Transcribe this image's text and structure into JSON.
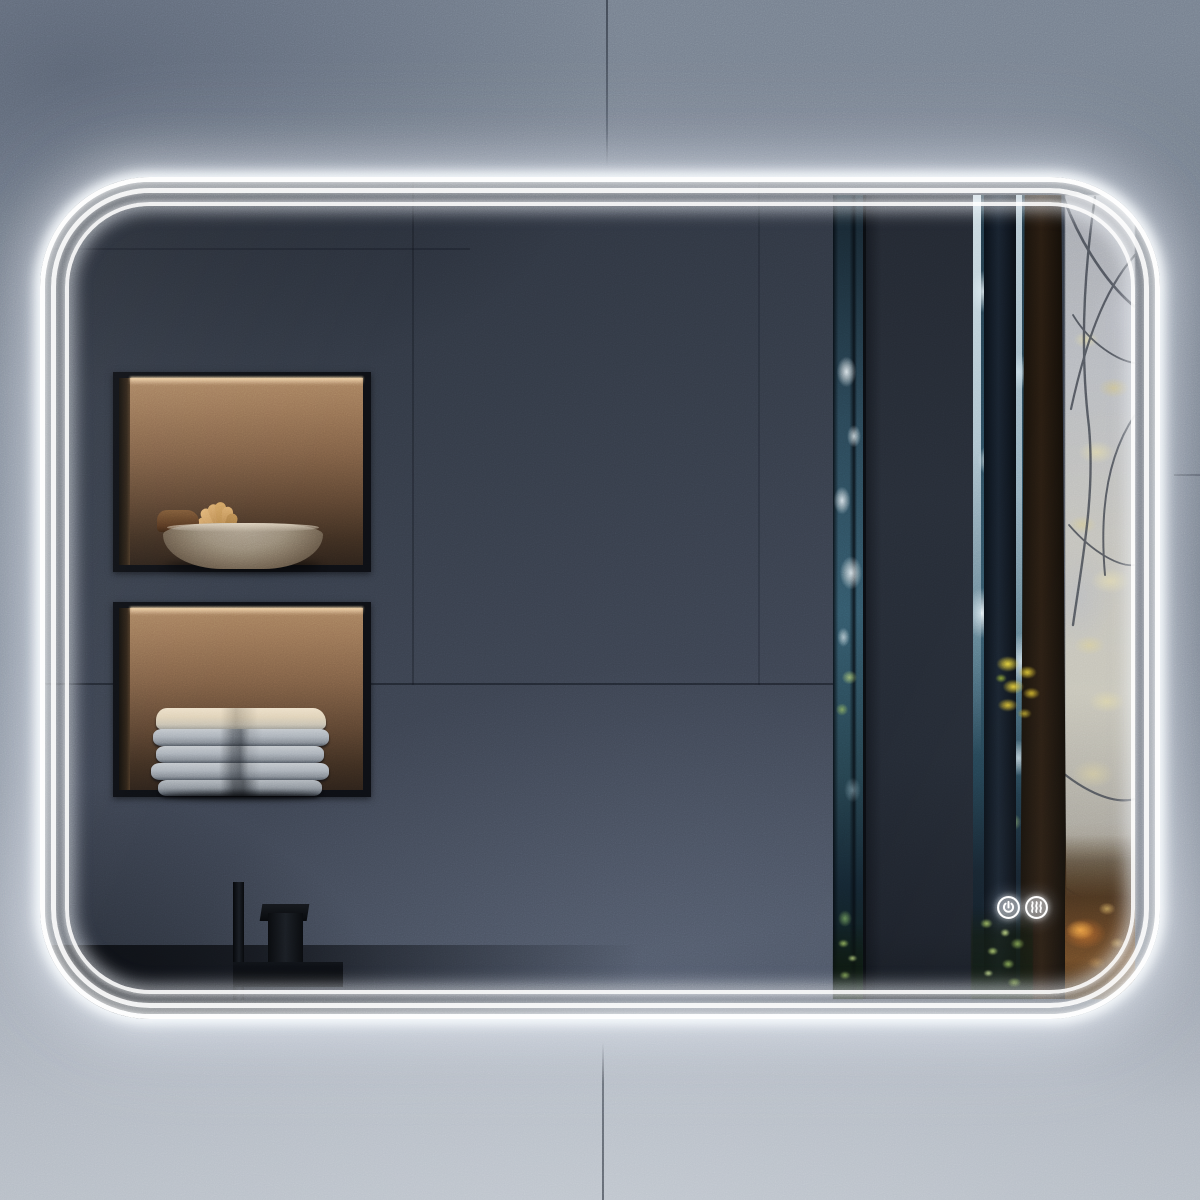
{
  "meta": {
    "description": "Product photograph of a rectangular LED bathroom mirror with rounded corners and a triple LED light band, mounted on a gray concrete-tile wall. The mirror reflects a dark modern bathroom with two warm-lit wall niches, a matte-black faucet and a misty autumn forest seen through a window.",
    "visible_text": "none"
  },
  "wall": {
    "material": "gray concrete tiles",
    "seams": [
      "vertical seam above mirror",
      "vertical seam below mirror",
      "horizontal seam right of mirror"
    ]
  },
  "mirror": {
    "shape": "rounded rectangle",
    "led_ring_count": 3,
    "led_state": "on",
    "touch_controls": [
      {
        "id": "power",
        "icon": "power-icon",
        "label": "Power touch sensor"
      },
      {
        "id": "defogger",
        "icon": "defogger-icon",
        "label": "Anti-fog heating touch sensor"
      }
    ]
  },
  "reflection": {
    "niches": [
      {
        "name": "upper-niche",
        "contents": "textured stone bowl with dried botanicals",
        "lighting": "warm LED strip"
      },
      {
        "name": "lower-niche",
        "contents": "stack of folded towels",
        "towel_count": 5,
        "lighting": "warm LED strip"
      }
    ],
    "fixtures": [
      "matte-black square faucet",
      "dark countertop"
    ],
    "window_view": "autumn forest: dark tree trunks, misty pale foliage, yellow leaves, green undergrowth and a dark wall panel"
  },
  "colors": {
    "wall_top": "#79828f",
    "wall_bottom": "#aeb5c0",
    "mirror_wall": "#3a414e",
    "led": "#ffffff",
    "niche_warm": "#a8815f",
    "panel_dark": "#262c36",
    "forest_teal": "#33586a",
    "forest_mist": "#c2c1bb",
    "autumn_yellow": "#e0c838",
    "foliage_green": "#9cc45e",
    "warm_floor": "#6a4622",
    "fixture_black": "#0b0d10"
  }
}
